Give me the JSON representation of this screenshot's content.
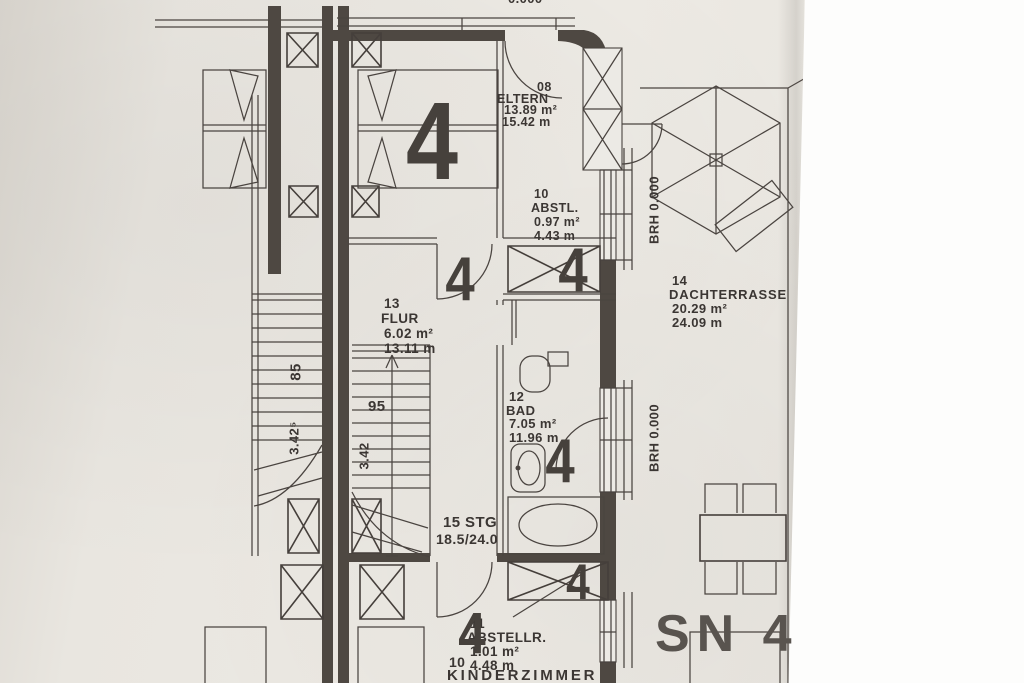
{
  "plan": {
    "unit_marker": "4",
    "sheet_label": "SN 4",
    "top_edge_partial": "0.000",
    "brh_label": "BRH 0.000",
    "rooms": {
      "eltern": {
        "id": "08",
        "name": "ELTERN",
        "area": "13.89 m²",
        "perimeter": "15.42 m"
      },
      "abstl": {
        "id": "10",
        "name": "ABSTL.",
        "area": "0.97 m²",
        "perimeter": "4.43 m"
      },
      "dachterrasse": {
        "id": "14",
        "name": "DACHTERRASSE",
        "area": "20.29 m²",
        "perimeter": "24.09 m"
      },
      "flur": {
        "id": "13",
        "name": "FLUR",
        "area": "6.02 m²",
        "perimeter": "13.11 m"
      },
      "bad": {
        "id": "12",
        "name": "BAD",
        "area": "7.05 m²",
        "perimeter": "11.96 m"
      },
      "abstellr": {
        "id": "11",
        "name": "ABSTELLR.",
        "area": "1.01 m²",
        "perimeter": "4.48 m"
      },
      "kinderzimmer": {
        "id": "10",
        "name": "KINDERZIMMER",
        "area_partial": "12.87 m²"
      }
    },
    "stairs": {
      "label": "15 STG",
      "ratio": "18.5/24.0",
      "width": "95",
      "adjacent_width": "85",
      "run": "3.42",
      "adjacent_run": "3.42⁵"
    },
    "colors": {
      "paper": "#eae6e0",
      "ink": "#4a4440"
    }
  }
}
